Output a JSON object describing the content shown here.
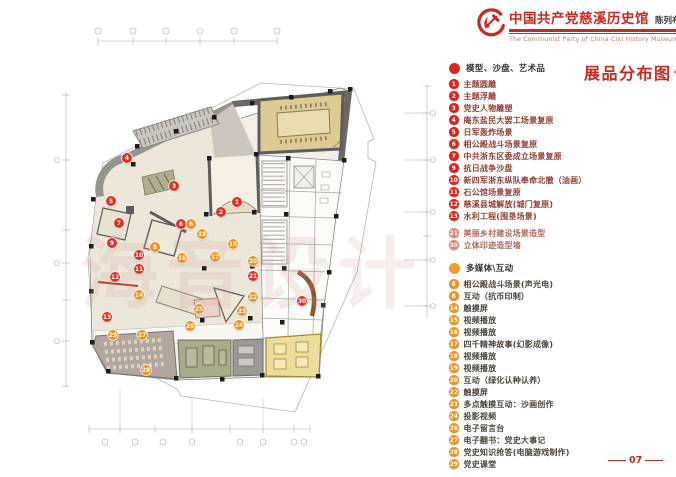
{
  "header": {
    "title_cn": "中国共产党慈溪历史馆",
    "subtitle": "陈列布展设计施工方案",
    "title_en": "The Communist Party of China Cixi  History Museum"
  },
  "legend": {
    "title": "展品分布图",
    "groups": [
      {
        "name": "模型、沙盘、艺术品",
        "kind": "red",
        "dot_color": "#d9251c",
        "items": [
          {
            "num": "1",
            "label": "主题圆雕"
          },
          {
            "num": "2",
            "label": "主题浮雕"
          },
          {
            "num": "3",
            "label": "党史人物雕塑"
          },
          {
            "num": "4",
            "label": "庵东盐民大罢工场景复原"
          },
          {
            "num": "5",
            "label": "日军轰炸场景"
          },
          {
            "num": "6",
            "label": "相公殿战斗场景复原"
          },
          {
            "num": "7",
            "label": "中共浙东区委成立场景复原"
          },
          {
            "num": "9",
            "label": "抗日战争沙盘"
          },
          {
            "num": "10",
            "label": "新四军浙东纵队奉命北撤（油画）"
          },
          {
            "num": "11",
            "label": "石公馆场景复原"
          },
          {
            "num": "12",
            "label": "慈溪县城解放(城门复原)"
          },
          {
            "num": "13",
            "label": "水利工程(围垦场景)"
          },
          {
            "num": "21",
            "label": "美丽乡村建设场景造型",
            "muted": true,
            "gap_before": true
          },
          {
            "num": "30",
            "label": "立体印迹造型墙",
            "muted": true
          }
        ]
      },
      {
        "name": "多媒体\\互动",
        "kind": "orange",
        "dot_color": "#ef9c30",
        "items": [
          {
            "num": "6",
            "label": "相公殿战斗场景(声光电)"
          },
          {
            "num": "8",
            "label": "互动（抗币印制）"
          },
          {
            "num": "14",
            "label": "触摸屏"
          },
          {
            "num": "15",
            "label": "视频播放"
          },
          {
            "num": "16",
            "label": "视频播放"
          },
          {
            "num": "17",
            "label": "四千精神故事(幻影成像)"
          },
          {
            "num": "18",
            "label": "视频播放"
          },
          {
            "num": "19",
            "label": "视频播放"
          },
          {
            "num": "20",
            "label": "互动（绿化认种认养）"
          },
          {
            "num": "22",
            "label": "触摸屏"
          },
          {
            "num": "23",
            "label": "多点触摸互动：沙画创作"
          },
          {
            "num": "24",
            "label": "投影视频"
          },
          {
            "num": "26",
            "label": "电子留言台"
          },
          {
            "num": "27",
            "label": "电子翻书：党史大事记"
          },
          {
            "num": "28",
            "label": "党史知识抢答(电脑游戏制作)"
          },
          {
            "num": "29",
            "label": "党史课堂"
          }
        ]
      }
    ]
  },
  "plan": {
    "watermark": "海音设计",
    "markers": [
      {
        "n": "1",
        "x": 237,
        "y": 202,
        "kind": "red"
      },
      {
        "n": "2",
        "x": 221,
        "y": 212,
        "kind": "red"
      },
      {
        "n": "3",
        "x": 174,
        "y": 186,
        "kind": "red"
      },
      {
        "n": "4",
        "x": 127,
        "y": 158,
        "kind": "red"
      },
      {
        "n": "5",
        "x": 111,
        "y": 201,
        "kind": "red"
      },
      {
        "n": "6",
        "x": 181,
        "y": 224,
        "kind": "red"
      },
      {
        "n": "7",
        "x": 119,
        "y": 223,
        "kind": "red"
      },
      {
        "n": "9",
        "x": 112,
        "y": 243,
        "kind": "red"
      },
      {
        "n": "10",
        "x": 139,
        "y": 255,
        "kind": "red"
      },
      {
        "n": "11",
        "x": 139,
        "y": 269,
        "kind": "red"
      },
      {
        "n": "12",
        "x": 115,
        "y": 277,
        "kind": "red"
      },
      {
        "n": "13",
        "x": 107,
        "y": 317,
        "kind": "red"
      },
      {
        "n": "21",
        "x": 253,
        "y": 276,
        "kind": "red"
      },
      {
        "n": "30",
        "x": 302,
        "y": 301,
        "kind": "red"
      },
      {
        "n": "6",
        "x": 191,
        "y": 224,
        "kind": "orange"
      },
      {
        "n": "8",
        "x": 155,
        "y": 247,
        "kind": "orange"
      },
      {
        "n": "14",
        "x": 139,
        "y": 295,
        "kind": "orange"
      },
      {
        "n": "15",
        "x": 233,
        "y": 244,
        "kind": "orange"
      },
      {
        "n": "16",
        "x": 182,
        "y": 258,
        "kind": "orange"
      },
      {
        "n": "17",
        "x": 215,
        "y": 257,
        "kind": "orange"
      },
      {
        "n": "18",
        "x": 202,
        "y": 234,
        "kind": "orange"
      },
      {
        "n": "20",
        "x": 253,
        "y": 261,
        "kind": "orange"
      },
      {
        "n": "22",
        "x": 253,
        "y": 297,
        "kind": "orange"
      },
      {
        "n": "23",
        "x": 242,
        "y": 311,
        "kind": "orange"
      },
      {
        "n": "24",
        "x": 239,
        "y": 325,
        "kind": "orange"
      },
      {
        "n": "25",
        "x": 199,
        "y": 309,
        "kind": "orange"
      },
      {
        "n": "26",
        "x": 190,
        "y": 326,
        "kind": "orange"
      },
      {
        "n": "27",
        "x": 142,
        "y": 335,
        "kind": "orange"
      },
      {
        "n": "28",
        "x": 146,
        "y": 370,
        "kind": "orange"
      },
      {
        "n": "29",
        "x": 113,
        "y": 335,
        "kind": "orange"
      }
    ]
  },
  "page": {
    "number": "07"
  }
}
